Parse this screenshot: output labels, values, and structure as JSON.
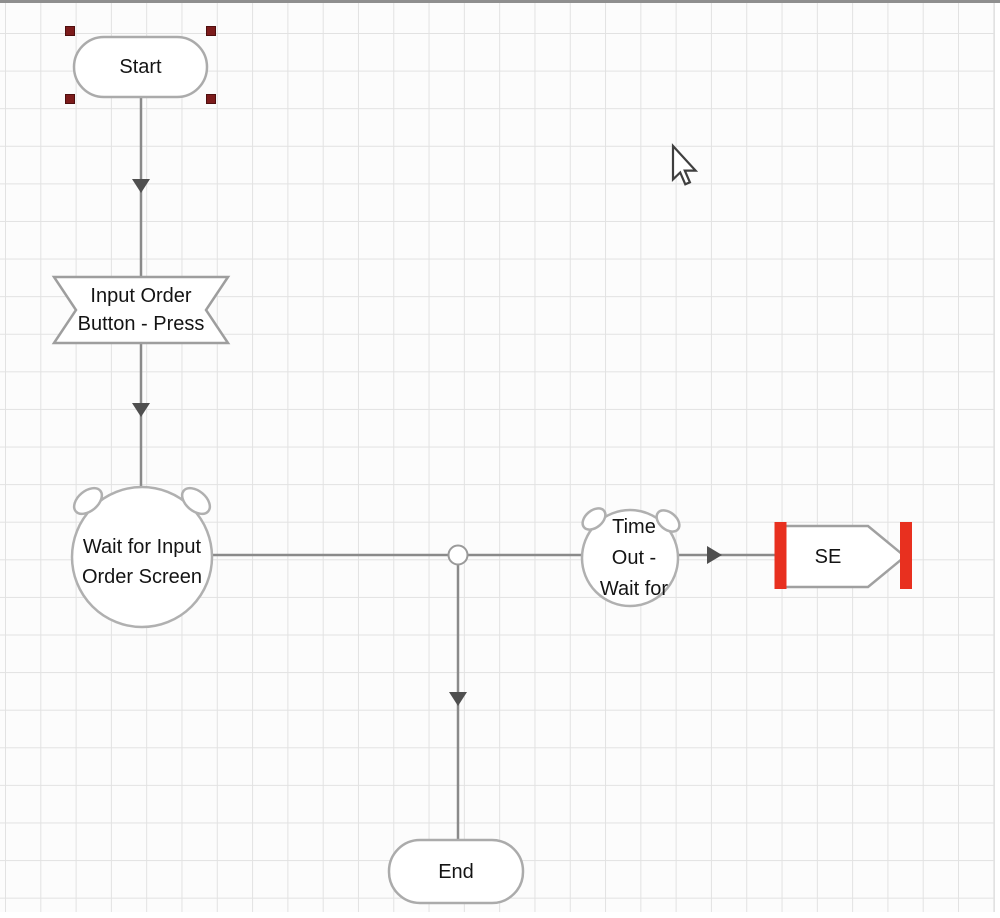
{
  "canvas": {
    "background_color": "#fcfcfc",
    "grid_line_color": "#e2e2e2",
    "top_border_color": "#8f8f8f"
  },
  "palette": {
    "connector": "#8a8a8a",
    "arrowhead": "#4f4f4f",
    "shape_border": "#ababab",
    "shape_fill": "#ffffff",
    "selection_handle": "#7c1b1b",
    "page_reference_bar": "#e8301f",
    "label_color": "#141414"
  },
  "nodes": {
    "start": {
      "shape": "terminator",
      "label": "Start",
      "selected": true
    },
    "input_order_press": {
      "shape": "notched-banner",
      "lines": [
        "Input Order",
        "Button - Press"
      ]
    },
    "wait_input_order_screen": {
      "shape": "wait-circle",
      "lines": [
        "Wait for Input",
        "Order Screen"
      ]
    },
    "time_out_wait": {
      "shape": "wait-circle",
      "lines": [
        "Time",
        "Out -",
        "Wait for"
      ]
    },
    "se_page_reference": {
      "shape": "page-reference",
      "label": "SE"
    },
    "end": {
      "shape": "terminator",
      "label": "End"
    }
  },
  "cursor": {
    "glyph": "arrow-pointer"
  }
}
